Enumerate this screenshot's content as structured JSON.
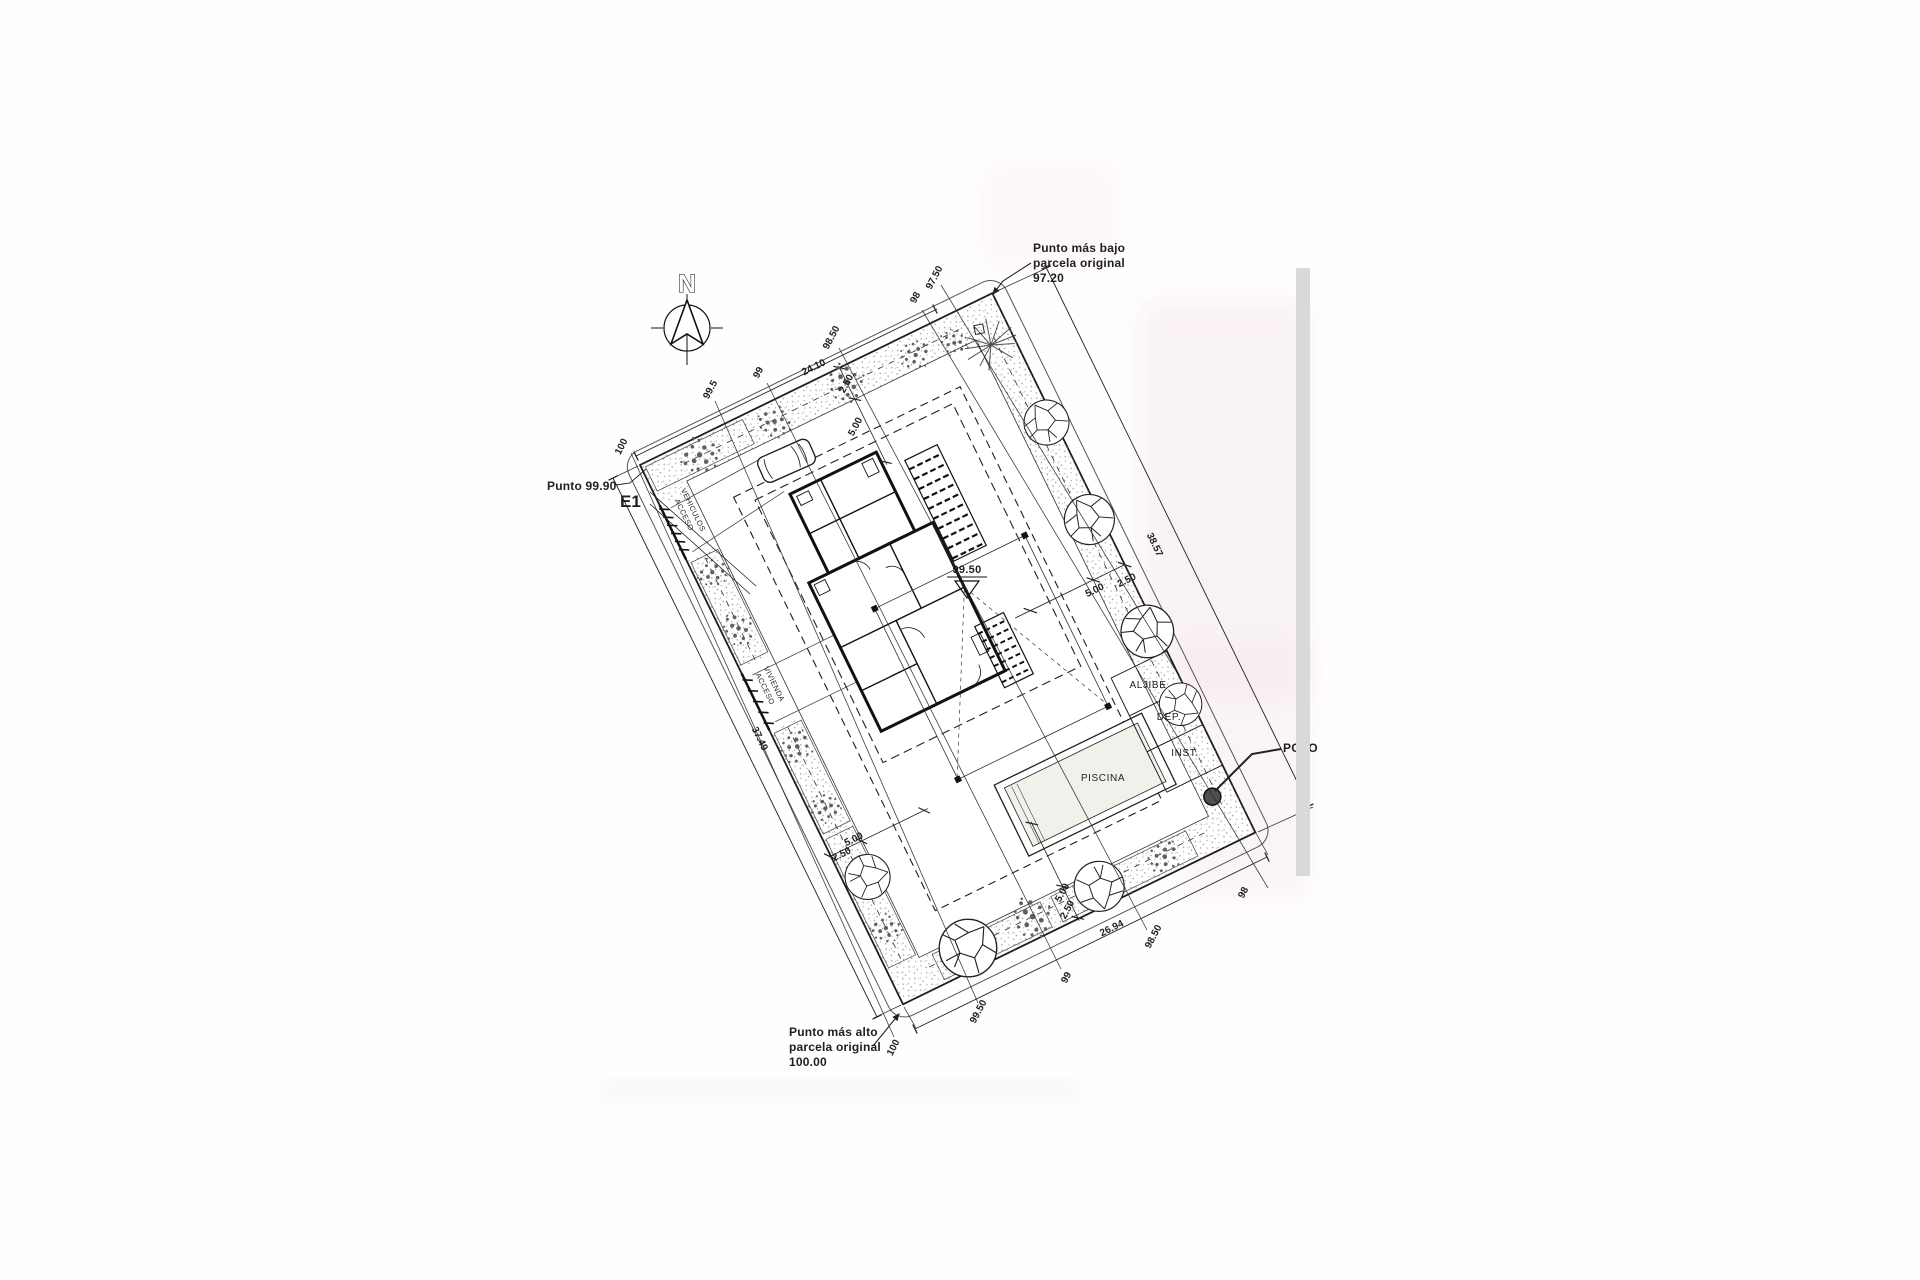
{
  "annotations": {
    "north": "N",
    "lowest_point": {
      "line1": "Punto más bajo",
      "line2": "parcela original",
      "value": "97.20"
    },
    "highest_point": {
      "line1": "Punto más alto",
      "line2": "parcela original",
      "value": "100.00"
    },
    "spot_level": "Punto 99.90",
    "section_mark": "E1",
    "well": "POZO"
  },
  "areas": {
    "pool": "PISCINA",
    "cistern": "ALJIBE",
    "dep": "DEP.",
    "inst": "INST.",
    "floor_level": "99.50",
    "vehicle_access": [
      "ACCESO",
      "VEHICULOS"
    ],
    "house_access": [
      "ACCESO",
      "VIVIENDA"
    ]
  },
  "dimensions": {
    "top_edge": "24.10",
    "top_band": "2.50",
    "top_setback": "5.00",
    "right_edge": "38.57",
    "right_band": "2.50",
    "right_setback": "5.00",
    "left_edge": "37.49",
    "left_band": "2.50",
    "left_setback": "5.00",
    "bottom_edge": "26.94",
    "bottom_band": "2.50",
    "bottom_setback": "5.00"
  },
  "contours": {
    "top": [
      "100",
      "99.5",
      "99",
      "98.50",
      "98",
      "97.50"
    ],
    "bottom": [
      "100",
      "99.50",
      "99",
      "98.50",
      "98"
    ]
  },
  "colors": {
    "ink": "#1f1f1f",
    "stipple_dots": "#8f8f8f",
    "pool_water": "#eef2ea",
    "scan_band": "#d9d9d9",
    "scan_pink": "#f5e7ea"
  }
}
